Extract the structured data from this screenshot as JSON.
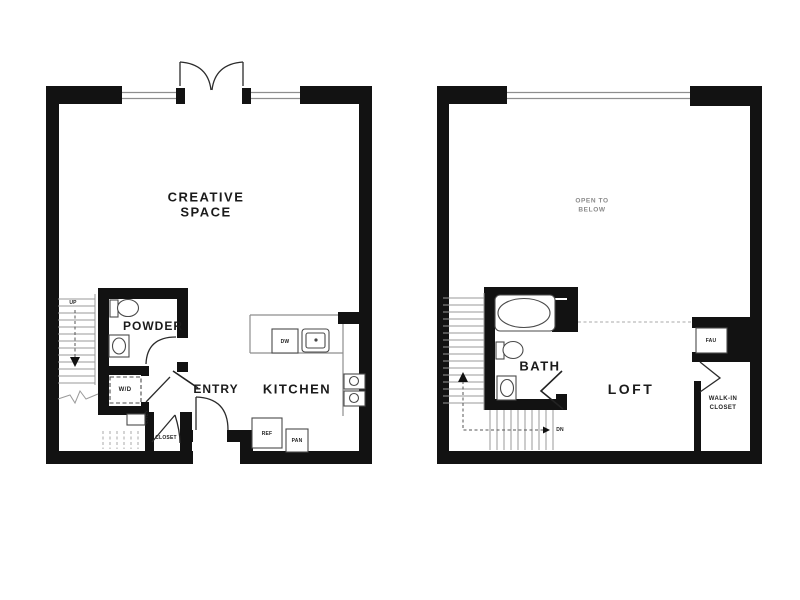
{
  "plans": {
    "first_floor": {
      "creative_space_line1": "CREATIVE",
      "creative_space_line2": "SPACE",
      "powder": "POWDER",
      "entry": "ENTRY",
      "kitchen": "KITCHEN",
      "closet": "CLOSET",
      "linen": "LINEN",
      "washer_dryer": "W/D",
      "dishwasher": "DW",
      "refrigerator": "REF",
      "pantry": "PAN",
      "stair_direction": "UP"
    },
    "loft_floor": {
      "open_to_below_line1": "OPEN TO",
      "open_to_below_line2": "BELOW",
      "bath": "BATH",
      "loft": "LOFT",
      "fau": "FAU",
      "walk_in_closet_line1": "WALK-IN",
      "walk_in_closet_line2": "CLOSET",
      "stair_direction": "DN"
    }
  },
  "colors": {
    "background": "#ffffff",
    "wall": "#121212",
    "thin_line": "#8e8e8e",
    "label": "#1b1b1b",
    "faint_label": "#8a8a8a"
  }
}
